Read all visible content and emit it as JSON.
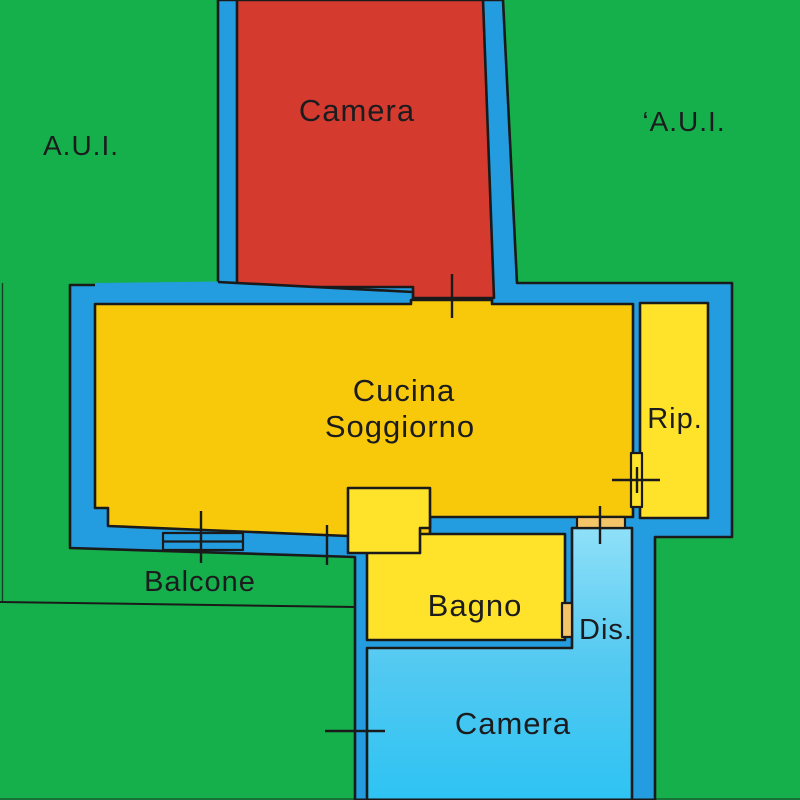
{
  "plan": {
    "labels": {
      "area_left": "A.U.I.",
      "area_right": "‘A.U.I.",
      "camera_top": "Camera",
      "cucina_line1": "Cucina",
      "cucina_line2": "Soggiorno",
      "rip": "Rip.",
      "balcone": "Balcone",
      "bagno": "Bagno",
      "dis": "Dis.",
      "camera_bottom": "Camera"
    },
    "colors": {
      "green": "#15B04B",
      "red": "#D53A2F",
      "wall_blue": "#249CE0",
      "gold": "#F8C90B",
      "yellow": "#FFE32A",
      "cyan": "#49C3F0",
      "cyan_light": "#8FE0F8",
      "tan": "#F4C468",
      "outline": "#1A1A1A"
    }
  }
}
